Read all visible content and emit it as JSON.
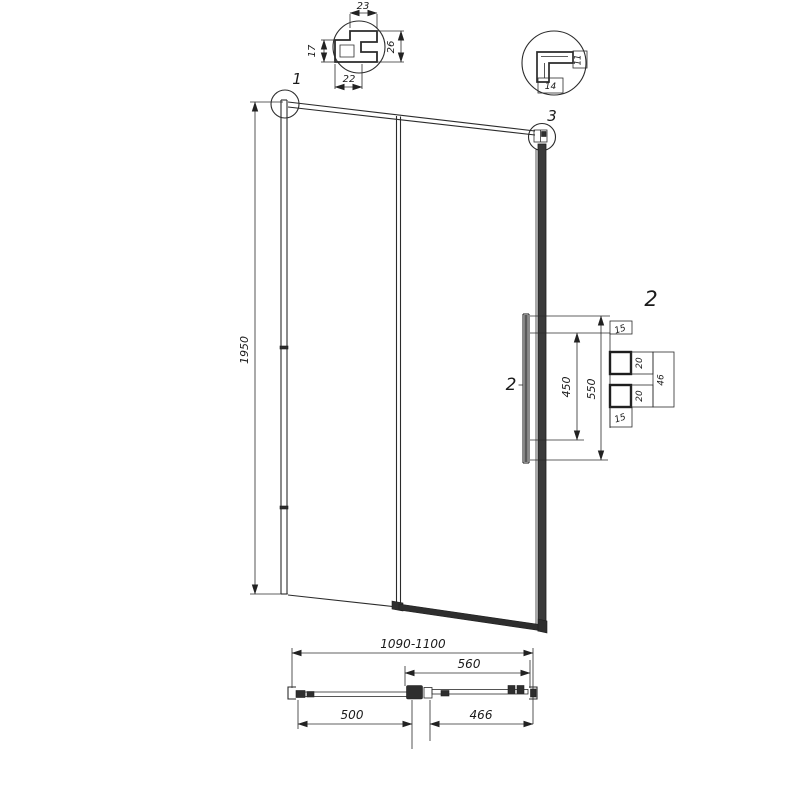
{
  "detail1": {
    "callout": "1",
    "top": "23",
    "left": "17",
    "right": "26",
    "bottom": "22"
  },
  "detail3": {
    "callout": "3",
    "side": "11",
    "bottom": "14"
  },
  "elevation": {
    "height": "1950",
    "handle": {
      "callout": "2",
      "detail_callout": "2",
      "hole_spacing": "450",
      "length": "550",
      "top_offset": "15",
      "knob_top": "20",
      "knob_pair": "46",
      "knob_bottom": "20",
      "bottom_offset": "15"
    }
  },
  "plan": {
    "overall": "1090-1100",
    "door": "560",
    "fixed": "500",
    "glass": "466"
  },
  "colors": {
    "line": "#2b2b2b",
    "background": "#ffffff"
  }
}
